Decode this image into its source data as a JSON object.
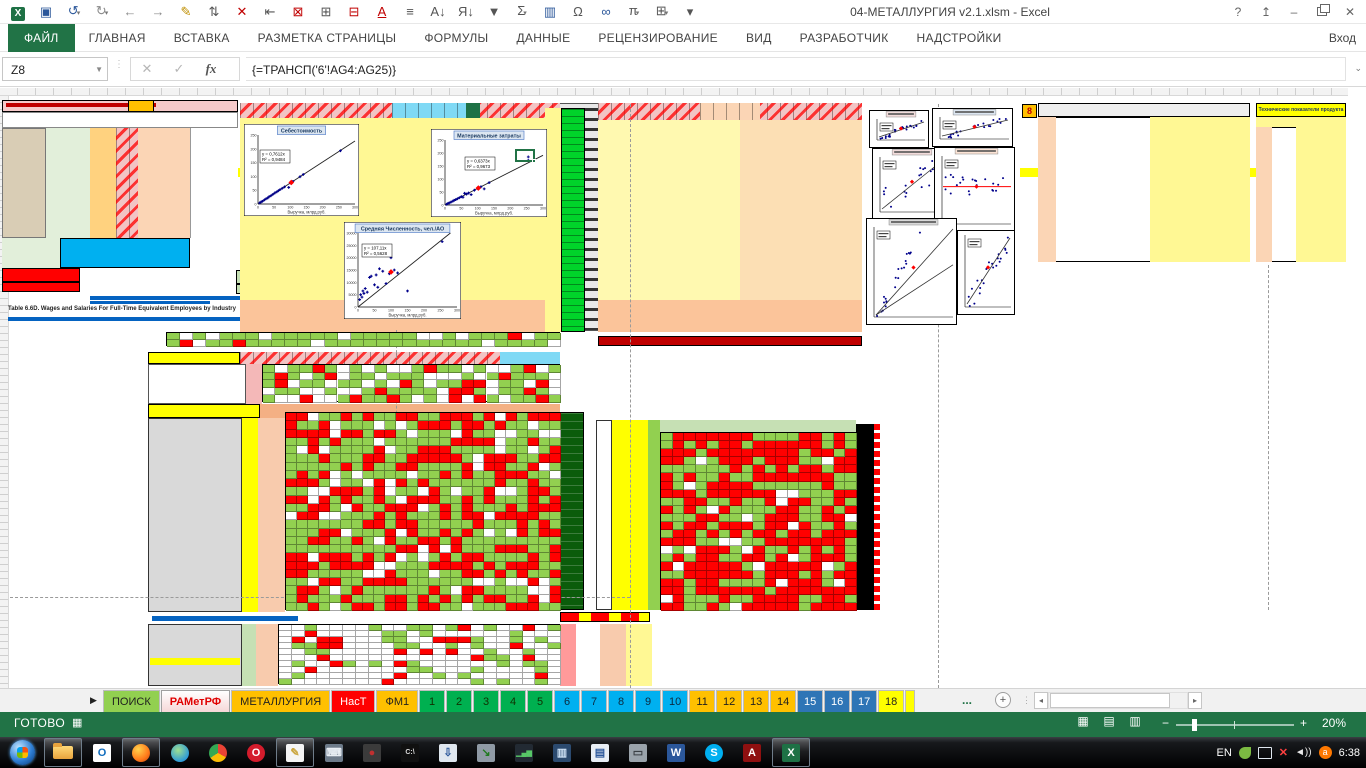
{
  "window": {
    "title": "04-МЕТАЛЛУРГИЯ v2.1.xlsm - Excel",
    "signin": "Вход",
    "help_glyph": "?",
    "min_glyph": "–",
    "close_glyph": "✕"
  },
  "qat": {
    "icons": [
      {
        "name": "excel-logo",
        "glyph": "X",
        "color": "#ffffff",
        "logo": true
      },
      {
        "name": "save-icon",
        "glyph": "▣",
        "color": "#2b579a"
      },
      {
        "name": "undo-icon",
        "glyph": "↺",
        "color": "#2b579a",
        "caret": true
      },
      {
        "name": "redo-icon",
        "glyph": "↻",
        "color": "#8a8a8a",
        "caret": true
      },
      {
        "name": "back-icon",
        "glyph": "←",
        "color": "#8a8a8a"
      },
      {
        "name": "forward-icon",
        "glyph": "→",
        "color": "#8a8a8a"
      },
      {
        "name": "format-painter-icon",
        "glyph": "✎",
        "color": "#bf8f00"
      },
      {
        "name": "insert-cells-icon",
        "glyph": "⇅",
        "color": "#555555"
      },
      {
        "name": "delete-cells-icon",
        "glyph": "✕",
        "color": "#c00000"
      },
      {
        "name": "indent-icon",
        "glyph": "⇤",
        "color": "#555555"
      },
      {
        "name": "delete-rows-icon",
        "glyph": "⊠",
        "color": "#c00000"
      },
      {
        "name": "insert-table-icon",
        "glyph": "⊞",
        "color": "#555555"
      },
      {
        "name": "delete-table-icon",
        "glyph": "⊟",
        "color": "#c00000"
      },
      {
        "name": "font-color-icon",
        "glyph": "A",
        "color": "#c00000"
      },
      {
        "name": "align-icon",
        "glyph": "≡",
        "color": "#555555"
      },
      {
        "name": "sort-asc-icon",
        "glyph": "А↓",
        "color": "#555555"
      },
      {
        "name": "sort-desc-icon",
        "glyph": "Я↓",
        "color": "#555555"
      },
      {
        "name": "filter-icon",
        "glyph": "▼",
        "color": "#555555"
      },
      {
        "name": "autosum-icon",
        "glyph": "Σ",
        "color": "#555555",
        "caret": true
      },
      {
        "name": "conditional-format-icon",
        "glyph": "▥",
        "color": "#2b579a"
      },
      {
        "name": "omega-icon",
        "glyph": "Ω",
        "color": "#555555"
      },
      {
        "name": "hyperlink-icon",
        "glyph": "∞",
        "color": "#2b579a"
      },
      {
        "name": "pi-icon",
        "glyph": "π",
        "color": "#555555",
        "caret": true
      },
      {
        "name": "borders-icon",
        "glyph": "⊞",
        "color": "#555555",
        "caret": true
      },
      {
        "name": "qat-customize-icon",
        "glyph": "▾",
        "color": "#555555"
      }
    ]
  },
  "ribbon": {
    "tabs": [
      {
        "label": "ФАЙЛ",
        "active": true
      },
      {
        "label": "ГЛАВНАЯ"
      },
      {
        "label": "ВСТАВКА"
      },
      {
        "label": "РАЗМЕТКА СТРАНИЦЫ"
      },
      {
        "label": "ФОРМУЛЫ"
      },
      {
        "label": "ДАННЫЕ"
      },
      {
        "label": "РЕЦЕНЗИРОВАНИЕ"
      },
      {
        "label": "ВИД"
      },
      {
        "label": "РАЗРАБОТЧИК"
      },
      {
        "label": "НАДСТРОЙКИ"
      }
    ]
  },
  "formula_bar": {
    "name_box": "Z8",
    "cancel_glyph": "✕",
    "enter_glyph": "✓",
    "fx_label": "fx",
    "formula": "{=ТРАНСП('6'!AG4:AG25)}"
  },
  "worksheet": {
    "note_line": "Table 6.6D. Wages and Salaries For Full-Time Equivalent Employees by Industry",
    "right_table_title": "Технические показатели продукта",
    "marker_8": "8"
  },
  "charts": [
    {
      "title": "Себестоимость",
      "eq1": "y = 0,7612x",
      "eq2": "R² = 0,9484",
      "xlabel": "Выручка, млрд.руб.",
      "x": 244,
      "y": 124,
      "w": 115,
      "h": 92,
      "xmax": 300,
      "ymax": 250,
      "k": 0.7612,
      "xticks": [
        0,
        50,
        100,
        150,
        200,
        250,
        300
      ],
      "yticks": [
        0,
        50,
        100,
        150,
        200,
        250
      ],
      "eqx": 16,
      "eqy": 26,
      "points": [
        [
          5,
          4
        ],
        [
          10,
          8
        ],
        [
          14,
          10
        ],
        [
          20,
          15
        ],
        [
          25,
          19
        ],
        [
          30,
          22
        ],
        [
          34,
          26
        ],
        [
          40,
          30
        ],
        [
          46,
          35
        ],
        [
          52,
          40
        ],
        [
          58,
          44
        ],
        [
          63,
          48
        ],
        [
          68,
          52
        ],
        [
          75,
          57
        ],
        [
          82,
          62
        ],
        [
          95,
          60
        ],
        [
          100,
          76
        ],
        [
          108,
          82
        ],
        [
          130,
          99
        ],
        [
          140,
          107
        ],
        [
          255,
          193
        ]
      ],
      "red": [
        103,
        78
      ]
    },
    {
      "title": "Материальные затраты",
      "eq1": "y = 0,6373x",
      "eq2": "R² = 0,9673",
      "xlabel": "Выручка, млрд.руб.",
      "x": 431,
      "y": 129,
      "w": 116,
      "h": 88,
      "xmax": 300,
      "ymax": 250,
      "k": 0.6373,
      "xticks": [
        0,
        50,
        100,
        150,
        200,
        250,
        300
      ],
      "yticks": [
        0,
        50,
        100,
        150,
        200,
        250
      ],
      "eqx": 34,
      "eqy": 28,
      "points": [
        [
          5,
          3
        ],
        [
          9,
          6
        ],
        [
          13,
          8
        ],
        [
          18,
          11
        ],
        [
          24,
          15
        ],
        [
          28,
          18
        ],
        [
          33,
          21
        ],
        [
          38,
          24
        ],
        [
          44,
          28
        ],
        [
          50,
          32
        ],
        [
          55,
          30
        ],
        [
          60,
          45
        ],
        [
          66,
          42
        ],
        [
          72,
          46
        ],
        [
          80,
          40
        ],
        [
          90,
          57
        ],
        [
          100,
          64
        ],
        [
          110,
          70
        ],
        [
          120,
          62
        ],
        [
          135,
          86
        ],
        [
          255,
          185
        ],
        [
          255,
          172
        ]
      ],
      "red": [
        102,
        65
      ]
    },
    {
      "title": "Средняя Численность, чел./АО",
      "eq1": "y = 107,11x",
      "eq2": "R² = 0,5628",
      "xlabel": "Выручка, млрд.руб.",
      "x": 344,
      "y": 222,
      "w": 117,
      "h": 97,
      "xmax": 300,
      "ymax": 30000,
      "k": 107.11,
      "xticks": [
        0,
        50,
        100,
        150,
        200,
        250,
        300
      ],
      "yticks": [
        0,
        5000,
        10000,
        15000,
        20000,
        25000,
        30000
      ],
      "eqx": 18,
      "eqy": 22,
      "points": [
        [
          5,
          3000
        ],
        [
          8,
          5000
        ],
        [
          12,
          4000
        ],
        [
          15,
          6500
        ],
        [
          18,
          5500
        ],
        [
          22,
          7500
        ],
        [
          28,
          6000
        ],
        [
          35,
          12000
        ],
        [
          40,
          12500
        ],
        [
          50,
          9000
        ],
        [
          55,
          13000
        ],
        [
          60,
          8000
        ],
        [
          65,
          15500
        ],
        [
          75,
          14500
        ],
        [
          85,
          9500
        ],
        [
          95,
          13500
        ],
        [
          100,
          20000
        ],
        [
          110,
          15000
        ],
        [
          120,
          13800
        ],
        [
          150,
          6500
        ],
        [
          255,
          26500
        ]
      ],
      "red": [
        100,
        14200
      ]
    }
  ],
  "mini_charts": [
    {
      "x": 869,
      "y": 110,
      "w": 60,
      "h": 38,
      "kind": "up",
      "tc": "#f2dcdb"
    },
    {
      "x": 932,
      "y": 108,
      "w": 81,
      "h": 39,
      "kind": "up",
      "tc": "#dce6f1"
    },
    {
      "x": 872,
      "y": 148,
      "w": 76,
      "h": 72,
      "kind": "loose",
      "tc": "#f2dcdb"
    },
    {
      "x": 934,
      "y": 147,
      "w": 81,
      "h": 85,
      "kind": "flat",
      "tc": "#fce4d6"
    },
    {
      "x": 866,
      "y": 218,
      "w": 91,
      "h": 107,
      "kind": "two",
      "tc": "#d9d9d9"
    },
    {
      "x": 957,
      "y": 230,
      "w": 58,
      "h": 85,
      "kind": "up",
      "tc": ""
    }
  ],
  "heatmaps": [
    {
      "x": 285,
      "y": 412,
      "w": 275,
      "h": 198,
      "cols": 25,
      "rows": 24,
      "seed": 7,
      "pr": 0.42,
      "pg": 0.46
    },
    {
      "x": 660,
      "y": 432,
      "w": 196,
      "h": 178,
      "cols": 17,
      "rows": 22,
      "seed": 13,
      "pr": 0.55,
      "pg": 0.38
    },
    {
      "x": 278,
      "y": 624,
      "w": 282,
      "h": 60,
      "cols": 22,
      "rows": 10,
      "seed": 21,
      "pr": 0.14,
      "pg": 0.22
    },
    {
      "x": 262,
      "y": 364,
      "w": 298,
      "h": 38,
      "cols": 24,
      "rows": 5,
      "seed": 5,
      "pr": 0.15,
      "pg": 0.55
    },
    {
      "x": 166,
      "y": 332,
      "w": 394,
      "h": 14,
      "cols": 30,
      "rows": 2,
      "seed": 9,
      "pr": 0.12,
      "pg": 0.7
    }
  ],
  "colors": {
    "heat_red": "#ff0000",
    "heat_green": "#92d050",
    "accent_green": "#217346"
  },
  "sheet_tabs": {
    "nav_glyph": "▶",
    "tabs": [
      {
        "label": "ПОИСК",
        "bg": "#92d050",
        "fg": "#1f1f1f"
      },
      {
        "label": "РАМетРФ",
        "bg": "#ffffff",
        "fg": "#e00000",
        "active": true
      },
      {
        "label": "МЕТАЛЛУРГИЯ",
        "bg": "#ffc000",
        "fg": "#1f1f1f"
      },
      {
        "label": "НасТ",
        "bg": "#ff0000",
        "fg": "#ffffff"
      },
      {
        "label": "ФМ1",
        "bg": "#ffc000",
        "fg": "#1f1f1f"
      },
      {
        "label": "1",
        "bg": "#00b050",
        "fg": "#103000"
      },
      {
        "label": "2",
        "bg": "#00b050",
        "fg": "#103000"
      },
      {
        "label": "3",
        "bg": "#00b050",
        "fg": "#103000"
      },
      {
        "label": "4",
        "bg": "#00b050",
        "fg": "#103000"
      },
      {
        "label": "5",
        "bg": "#00b050",
        "fg": "#103000"
      },
      {
        "label": "6",
        "bg": "#00b0f0",
        "fg": "#0b2a40"
      },
      {
        "label": "7",
        "bg": "#00b0f0",
        "fg": "#0b2a40"
      },
      {
        "label": "8",
        "bg": "#00b0f0",
        "fg": "#0b2a40"
      },
      {
        "label": "9",
        "bg": "#00b0f0",
        "fg": "#0b2a40"
      },
      {
        "label": "10",
        "bg": "#00b0f0",
        "fg": "#0b2a40"
      },
      {
        "label": "11",
        "bg": "#ffc000",
        "fg": "#1f1f1f"
      },
      {
        "label": "12",
        "bg": "#ffc000",
        "fg": "#1f1f1f"
      },
      {
        "label": "13",
        "bg": "#ffc000",
        "fg": "#1f1f1f"
      },
      {
        "label": "14",
        "bg": "#ffc000",
        "fg": "#1f1f1f"
      },
      {
        "label": "15",
        "bg": "#2e75b6",
        "fg": "#ffffff"
      },
      {
        "label": "16",
        "bg": "#2e75b6",
        "fg": "#ffffff"
      },
      {
        "label": "17",
        "bg": "#2e75b6",
        "fg": "#ffffff"
      },
      {
        "label": "18",
        "bg": "#ffff00",
        "fg": "#1f1f1f"
      }
    ],
    "more": "...",
    "add": "+"
  },
  "status_bar": {
    "ready": "ГОТОВО",
    "zoom": "20%",
    "macro_glyph": "▦",
    "view_icons": [
      {
        "name": "normal-view-icon",
        "glyph": "▦"
      },
      {
        "name": "page-layout-view-icon",
        "glyph": "▤"
      },
      {
        "name": "page-break-view-icon",
        "glyph": "▥"
      }
    ]
  },
  "taskbar": {
    "items": [
      {
        "name": "start-button",
        "kind": "orb"
      },
      {
        "name": "explorer-icon",
        "kind": "folder",
        "active": true
      },
      {
        "name": "outlook-icon",
        "kind": "sq",
        "bg": "#ffffff",
        "fg": "#0f6cbd",
        "ch": "O"
      },
      {
        "name": "firefox-icon",
        "kind": "circ",
        "bg": "radial-gradient(circle at 35% 30%,#ffd24d,#ff7a1a 60%,#c2410c)",
        "ch": "",
        "active": true
      },
      {
        "name": "globe-icon",
        "kind": "circ",
        "bg": "radial-gradient(circle at 40% 35%,#9fe08f,#2f9bd6 70%)",
        "ch": ""
      },
      {
        "name": "chrome-icon",
        "kind": "circ",
        "bg": "conic-gradient(#ea4335 0 33%,#fbbc05 0 66%,#34a853 0)",
        "ch": ""
      },
      {
        "name": "opera-icon",
        "kind": "circ",
        "bg": "#d41c2c",
        "ch": "O"
      },
      {
        "name": "notepad-icon",
        "kind": "sq",
        "bg": "#f5f5f5",
        "fg": "#caa53d",
        "ch": "✎",
        "active": true
      },
      {
        "name": "keyboard-icon",
        "kind": "sq",
        "bg": "#6d7b8a",
        "fg": "#e8eef4",
        "ch": "⌨"
      },
      {
        "name": "device-app-icon",
        "kind": "sq",
        "bg": "#3b3b3b",
        "fg": "#c03030",
        "ch": "●"
      },
      {
        "name": "cmd-icon",
        "kind": "sq",
        "bg": "#101010",
        "fg": "#dcdcdc",
        "ch": "C:\\"
      },
      {
        "name": "installer-icon",
        "kind": "sq",
        "bg": "#dfe7ef",
        "fg": "#2b579a",
        "ch": "⇩"
      },
      {
        "name": "backup-icon",
        "kind": "sq",
        "bg": "#8f9aa5",
        "fg": "#1f7a1f",
        "ch": "↘"
      },
      {
        "name": "monitor-chart-icon",
        "kind": "sq",
        "bg": "#222a33",
        "fg": "#57c767",
        "ch": "▁▄▆"
      },
      {
        "name": "monitor-app-icon",
        "kind": "sq",
        "bg": "#2b4a6f",
        "fg": "#cfe3f7",
        "ch": "▥"
      },
      {
        "name": "doc-app-icon",
        "kind": "sq",
        "bg": "#e8eef5",
        "fg": "#2b579a",
        "ch": "▤"
      },
      {
        "name": "printer-icon",
        "kind": "sq",
        "bg": "#9aa3ab",
        "fg": "#3a3f44",
        "ch": "▭"
      },
      {
        "name": "word-icon",
        "kind": "sq",
        "bg": "#2b579a",
        "fg": "#ffffff",
        "ch": "W"
      },
      {
        "name": "skype-icon",
        "kind": "circ",
        "bg": "#00aff0",
        "ch": "S"
      },
      {
        "name": "acrobat-icon",
        "kind": "sq",
        "bg": "#8f1010",
        "fg": "#ffffff",
        "ch": "A"
      },
      {
        "name": "excel-icon",
        "kind": "sq",
        "bg": "#1e7145",
        "fg": "#ffffff",
        "ch": "X",
        "active": true
      }
    ],
    "tray": {
      "lang": "EN",
      "time": "6:38"
    }
  }
}
